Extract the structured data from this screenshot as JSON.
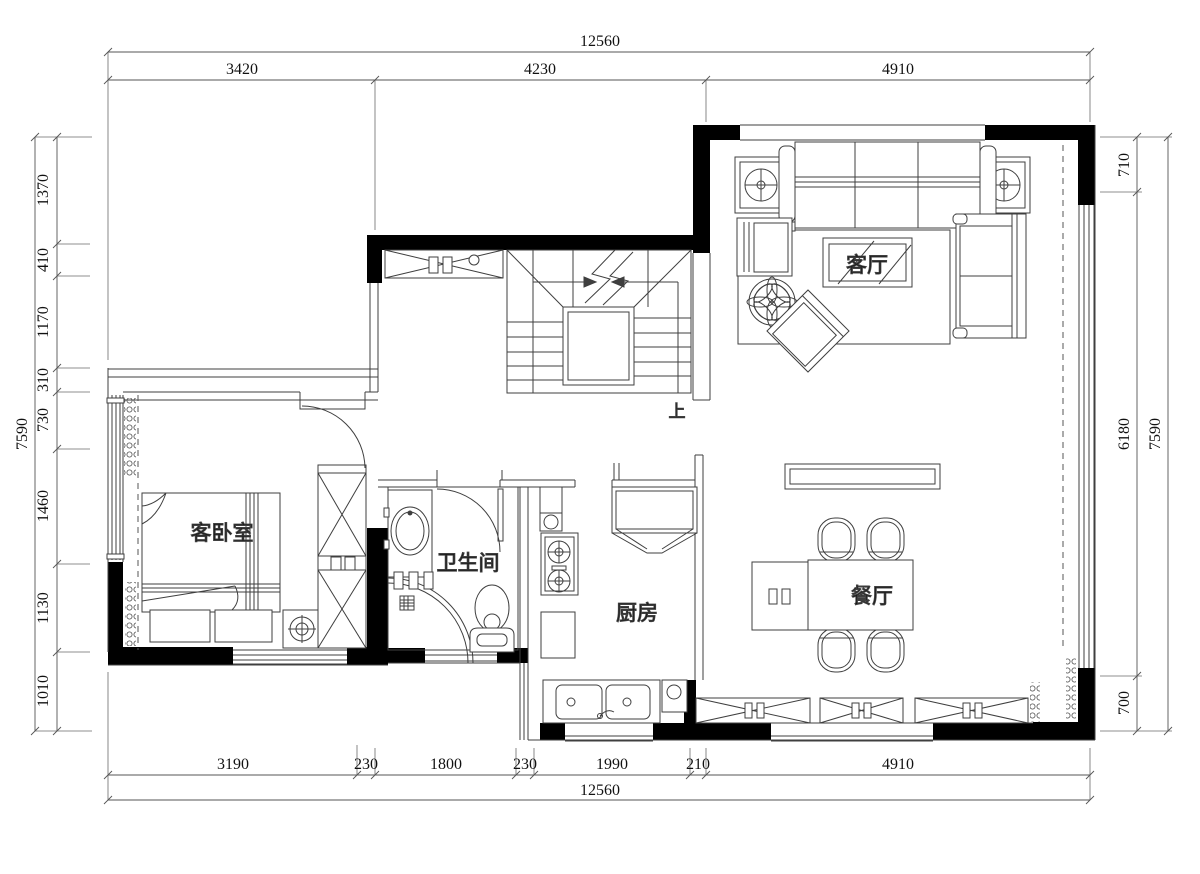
{
  "drawing": {
    "rooms": {
      "living": "客厅",
      "bedroom": "客卧室",
      "bathroom": "卫生间",
      "kitchen": "厨房",
      "dining": "餐厅"
    },
    "stairs_up": "上",
    "dims": {
      "top": {
        "total": "12560",
        "segs": [
          "3420",
          "4230",
          "4910"
        ]
      },
      "bottom": {
        "total": "12560",
        "segs": [
          "3190",
          "230",
          "1800",
          "230",
          "1990",
          "210",
          "4910"
        ]
      },
      "left": {
        "total": "7590",
        "segs": [
          "1370",
          "410",
          "1170",
          "310",
          "730",
          "1460",
          "1130",
          "1010"
        ]
      },
      "right": {
        "total": "7590",
        "segs": [
          "710",
          "6180",
          "700"
        ]
      }
    },
    "colors": {
      "wall": "#000000",
      "line": "#4a4a4a",
      "text": "#111111"
    }
  }
}
